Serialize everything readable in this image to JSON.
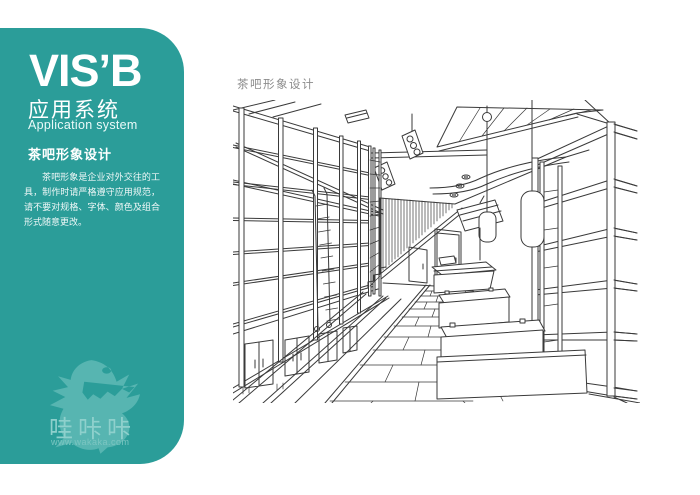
{
  "sidebar": {
    "brand": "VIS’B",
    "system_cn": "应用系统",
    "system_en": "Application system",
    "section_title": "茶吧形象设计",
    "description": "茶吧形象是企业对外交往的工具，制作时请严格遵守应用规范，请不要对规格、字体、颜色及组合形式随意更改。",
    "mascot_name": "哇咔咔",
    "mascot_url": "www.wakaka.com",
    "colors": {
      "panel": "#2b9d99",
      "mascot": "#57b5b1",
      "text": "#ffffff"
    }
  },
  "main": {
    "title": "茶吧形象设计",
    "illustration": "tea-bar-interior-hand-sketch",
    "sketch_line_color": "#3a3a3a"
  }
}
